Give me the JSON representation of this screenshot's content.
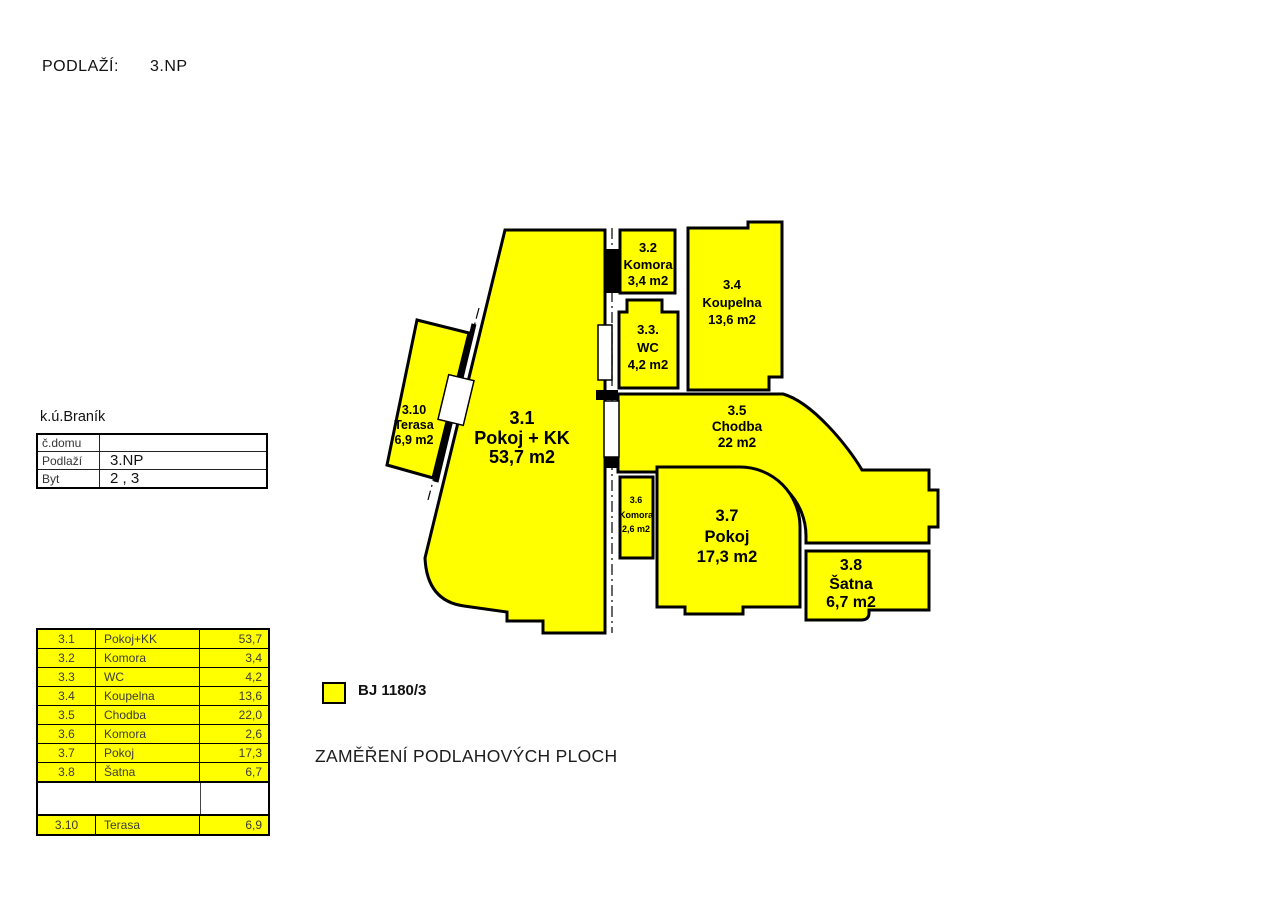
{
  "page": {
    "floor_label": "PODLAŽÍ:",
    "floor_value": "3.NP",
    "caption": "ZAMĚŘENÍ PODLAHOVÝCH PLOCH"
  },
  "cadastre": {
    "title": "k.ú.Braník",
    "rows": [
      {
        "label": "č.domu",
        "value": ""
      },
      {
        "label": "Podlaží",
        "value": "3.NP"
      },
      {
        "label": "Byt",
        "value": "2 , 3"
      }
    ]
  },
  "legend": {
    "label": "BJ 1180/3",
    "swatch_color": "#ffff00"
  },
  "rooms": [
    {
      "id": "3.1",
      "name": "Pokoj + KK",
      "area": "53,7 m2"
    },
    {
      "id": "3.2",
      "name": "Komora",
      "area": "3,4 m2"
    },
    {
      "id": "3.3.",
      "name": "WC",
      "area": "4,2 m2"
    },
    {
      "id": "3.4",
      "name": "Koupelna",
      "area": "13,6 m2"
    },
    {
      "id": "3.5",
      "name": "Chodba",
      "area": "22 m2"
    },
    {
      "id": "3.6",
      "name": "Komora",
      "area": "2,6 m2"
    },
    {
      "id": "3.7",
      "name": "Pokoj",
      "area": "17,3 m2"
    },
    {
      "id": "3.8",
      "name": "Šatna",
      "area": "6,7 m2"
    },
    {
      "id": "3.10",
      "name": "Terasa",
      "area": "6,9 m2"
    }
  ],
  "area_table": {
    "rows": [
      {
        "no": "3.1",
        "name": "Pokoj+KK",
        "value": "53,7"
      },
      {
        "no": "3.2",
        "name": "Komora",
        "value": "3,4"
      },
      {
        "no": "3.3",
        "name": "WC",
        "value": "4,2"
      },
      {
        "no": "3.4",
        "name": "Koupelna",
        "value": "13,6"
      },
      {
        "no": "3.5",
        "name": "Chodba",
        "value": "22,0"
      },
      {
        "no": "3.6",
        "name": "Komora",
        "value": "2,6"
      },
      {
        "no": "3.7",
        "name": "Pokoj",
        "value": "17,3"
      },
      {
        "no": "3.8",
        "name": "Šatna",
        "value": "6,7"
      }
    ],
    "terrace_row": {
      "no": "3.10",
      "name": "Terasa",
      "value": "6,9"
    }
  },
  "colors": {
    "room_fill": "#ffff00",
    "outline": "#000000"
  }
}
